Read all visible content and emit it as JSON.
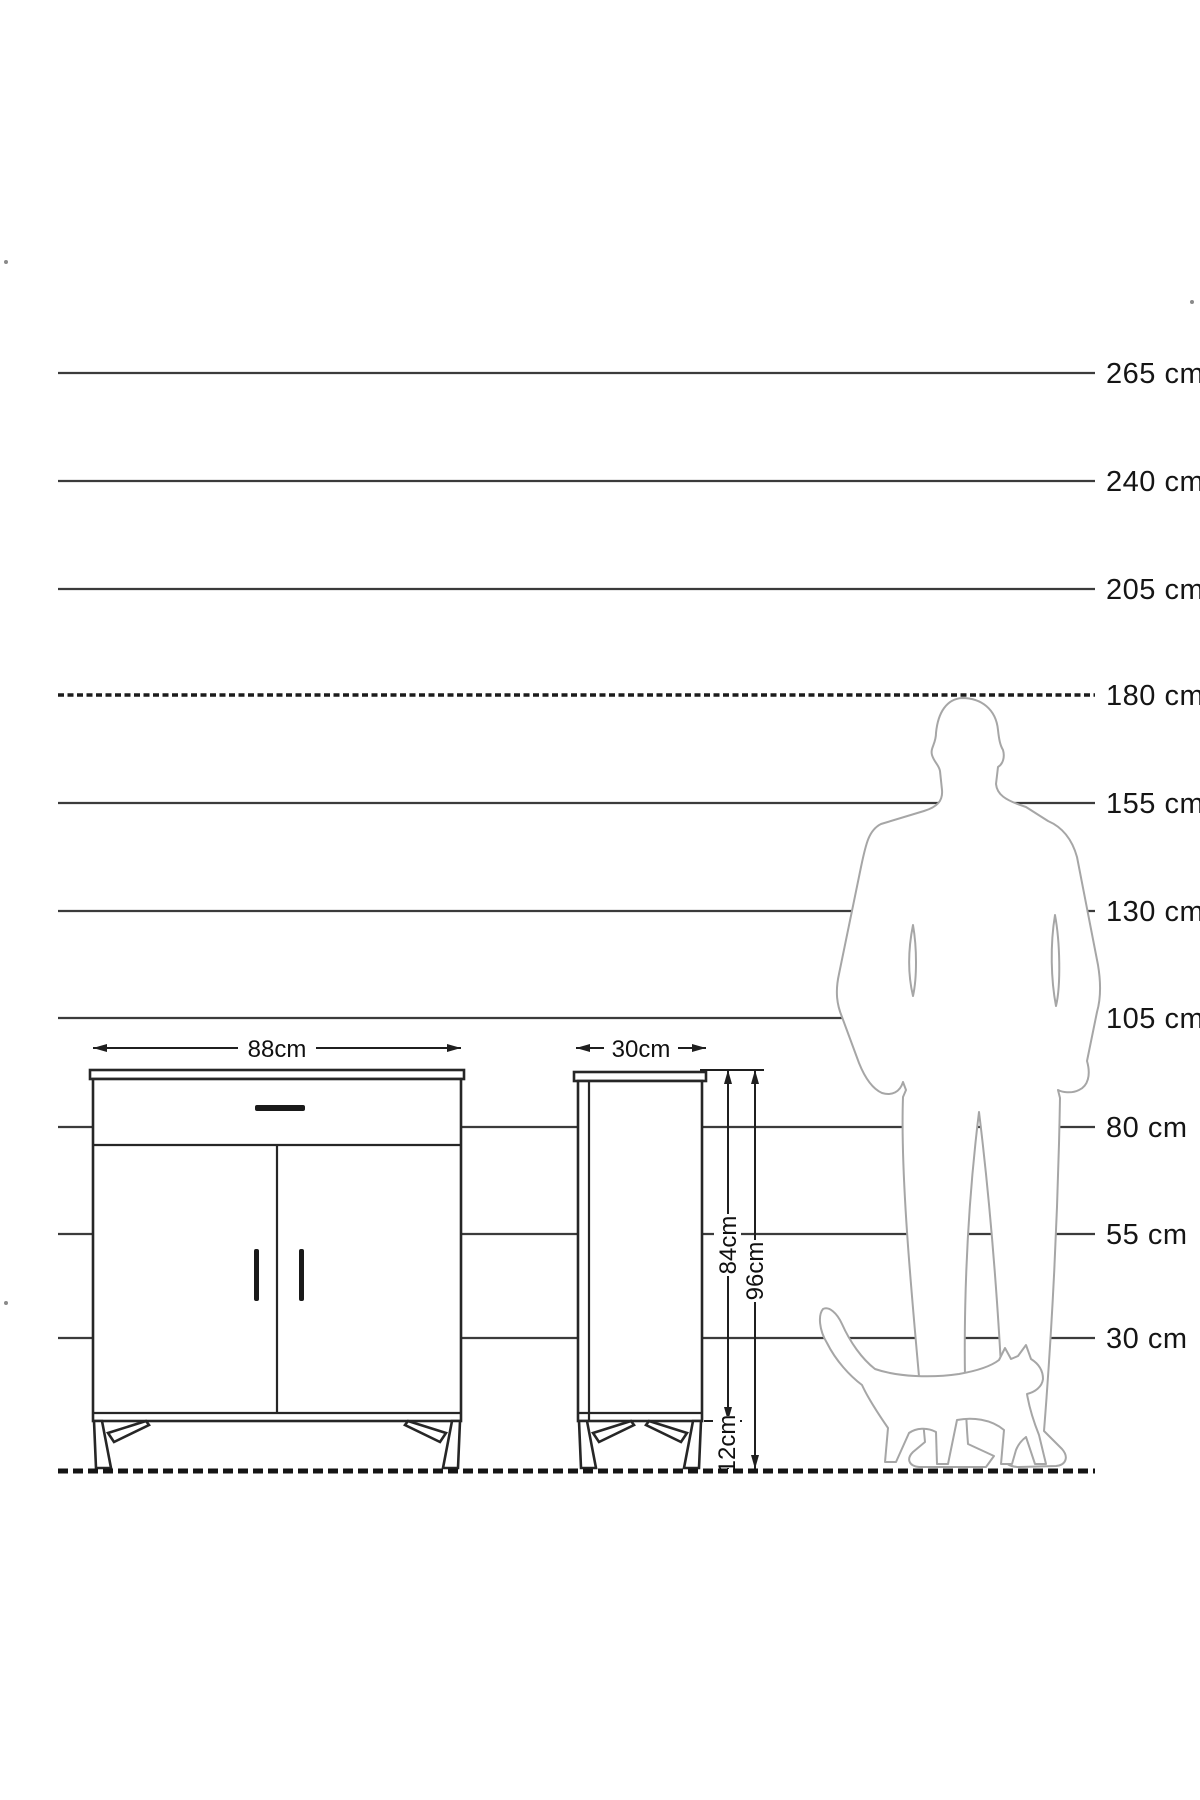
{
  "diagram": {
    "kind": "furniture-height-scale-diagram",
    "ruler": {
      "unit": "cm",
      "labels": [
        "265 cm",
        "240 cm",
        "205 cm",
        "180 cm",
        "155 cm",
        "130 cm",
        "105 cm",
        "80 cm",
        "55 cm",
        "30 cm"
      ],
      "values": [
        265,
        240,
        205,
        180,
        155,
        130,
        105,
        80,
        55,
        30
      ]
    },
    "front_view": {
      "width_label": "88cm"
    },
    "side_view": {
      "depth_label": "30cm",
      "body_height_label": "84cm",
      "total_height_label": "96cm",
      "leg_height_label": "12cm"
    },
    "figures": {
      "man": "man-silhouette",
      "cat": "cat-silhouette"
    },
    "colors": {
      "background": "#ffffff",
      "ruler_line": "#3b3b3b",
      "ink": "#151515",
      "silhouette_outline": "#a6a6a6"
    }
  }
}
